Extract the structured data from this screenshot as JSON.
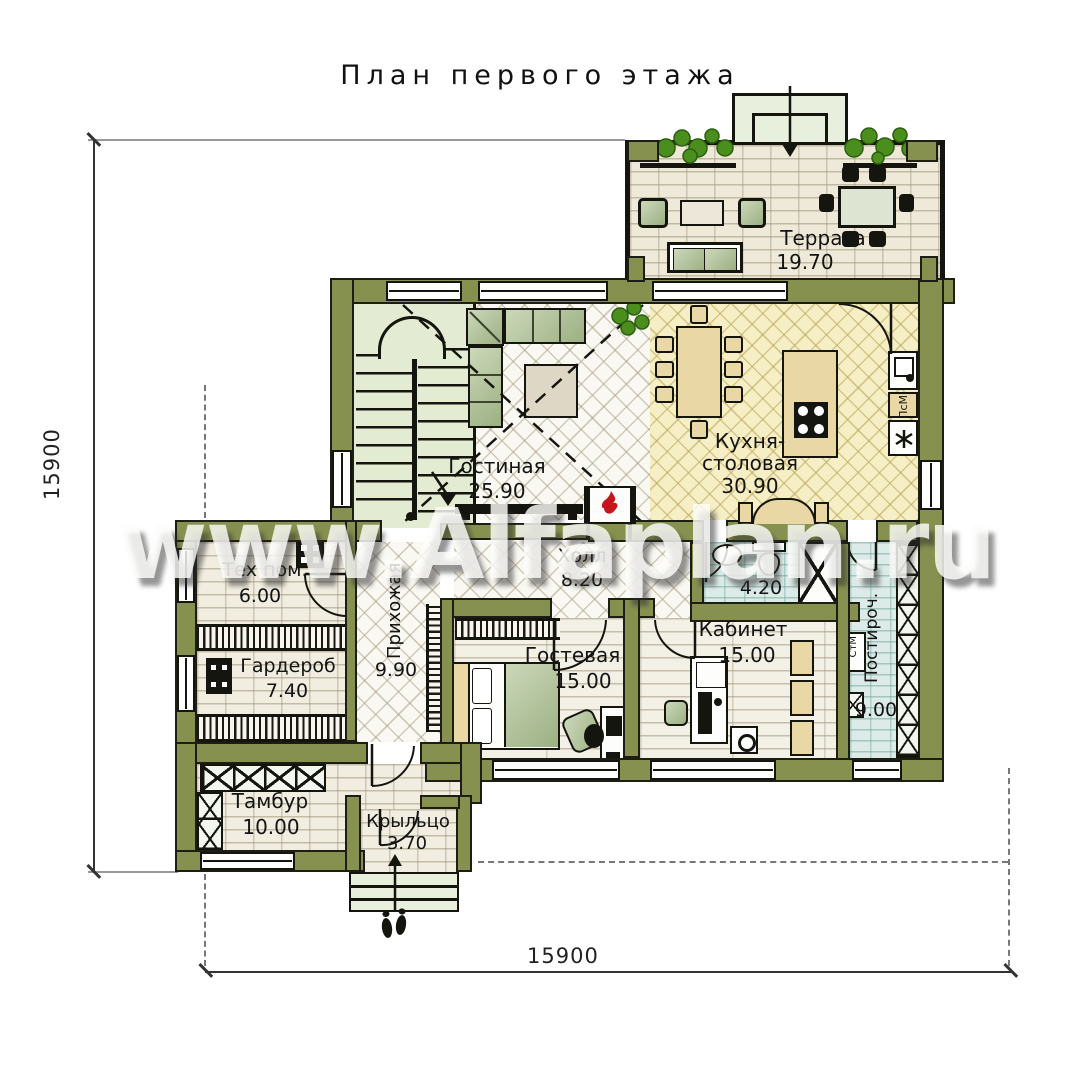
{
  "title": "План первого этажа",
  "watermark": "www.Alfaplan.ru",
  "dimensions": {
    "left": "15900",
    "bottom": "15900"
  },
  "rooms": {
    "terrace": {
      "name": "Терраса",
      "area": "19.70"
    },
    "living": {
      "name": "Гостиная",
      "area": "25.90"
    },
    "kitchen": {
      "line1": "Кухня-",
      "line2": "столовая",
      "area": "30.90"
    },
    "hall": {
      "name": "Холл",
      "area": "8.20"
    },
    "bathroom": {
      "area": "4.20"
    },
    "tech": {
      "name": "Тех пом.",
      "area": "6.00"
    },
    "wardrobe": {
      "name": "Гардероб",
      "area": "7.40"
    },
    "hallway": {
      "name": "Прихожая",
      "area": "9.90"
    },
    "guest": {
      "name": "Гостевая",
      "area": "15.00"
    },
    "study": {
      "name": "Кабинет",
      "area": "15.00"
    },
    "laundry": {
      "name": "Постироч.",
      "area": "9.00"
    },
    "tambour": {
      "name": "Тамбур",
      "area": "10.00"
    },
    "porch": {
      "name": "Крыльцо",
      "area": "3.70"
    }
  },
  "appliances": {
    "dishwasher": "ПсМ",
    "washer": "СтМ"
  },
  "icons": {
    "fridge": "asterisk-snowflake",
    "fireplace": "flame",
    "entry": "footprints",
    "terrace_planters": "greenery",
    "living_plant": "greenery",
    "stairs": "u-shaped-staircase",
    "entry_arrow": "down-arrow"
  },
  "colors": {
    "wall": "#87914f",
    "living_floor": "#faf8f2",
    "kitchen_floor": "#f6efc6",
    "wet_floor": "#dcebe7",
    "stair_floor": "#e3ecd2",
    "brick_floor": "#f1ede0",
    "plank_floor": "#f3f0e6",
    "sofa": "#b3c39a",
    "wood_furniture": "#e9d8a6",
    "flame": "#c4161c",
    "plant": "#4a8f1e"
  }
}
